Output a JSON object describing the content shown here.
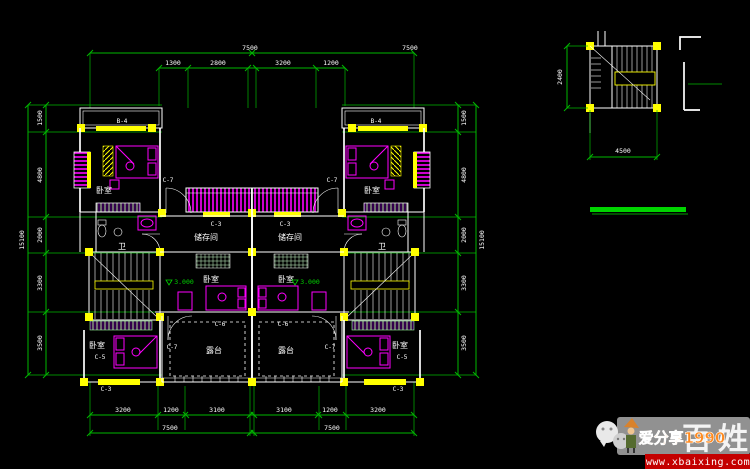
{
  "colors": {
    "background": "#000000",
    "dimension_green": "#00b800",
    "highlight_green": "#00d400",
    "wall_white": "#ffffff",
    "fixture_magenta": "#ff00ff",
    "node_yellow": "#ffff00",
    "watermark_red": "#c40000",
    "brand_orange": "#ff8a1e"
  },
  "dims": {
    "top_total": [
      "7500",
      "7500"
    ],
    "top_sub": [
      "1300",
      "2800",
      "3200",
      "1200"
    ],
    "bottom_sub": [
      "3200",
      "1200",
      "3100",
      "3100",
      "1200",
      "3200"
    ],
    "bottom_total": [
      "7500",
      "7500"
    ],
    "left_sub": [
      "1500",
      "4800",
      "2000",
      "3300",
      "3500"
    ],
    "left_total": "15100",
    "right_sub": [
      "1500",
      "4800",
      "2000",
      "3300",
      "3500"
    ],
    "right_total": "15100",
    "detail_width": "4500",
    "detail_height": "2400"
  },
  "rooms": {
    "bedroom": "卧室",
    "storage": "储存间",
    "terrace": "露台",
    "bath": "卫"
  },
  "tags": {
    "b4": "B-4",
    "c7": "C-7",
    "c3": "C-3",
    "c6": "C-6",
    "c5": "C-5"
  },
  "elevation": "3.000",
  "watermark": {
    "brand": "爱分享1990",
    "site": "www.xbaixing.com",
    "logo_chars": [
      "百",
      "姓"
    ]
  }
}
